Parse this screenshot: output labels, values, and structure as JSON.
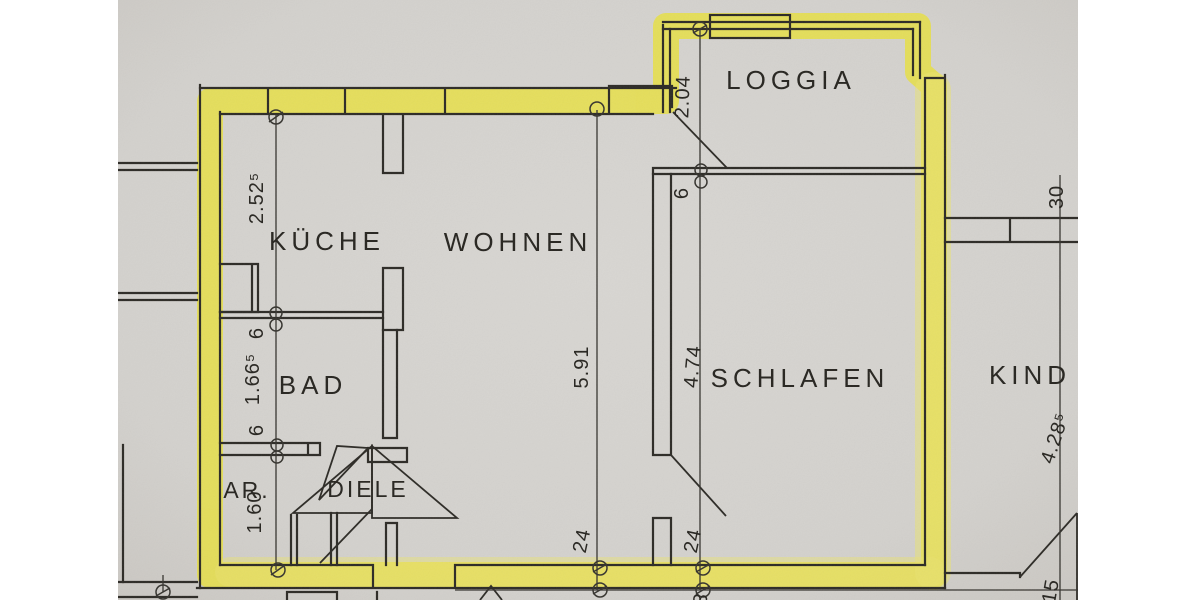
{
  "document": {
    "kind": "scanned apartment floor plan, apartment outlined with yellow highlighter",
    "language": "German"
  },
  "colors": {
    "highlight": "#e9e13e",
    "highlight_soft": "#efe75a",
    "paper": "#d5d3cf",
    "paper_edge": "#cbc8c3",
    "ink": "#2c2a25",
    "page": "#ffffff"
  },
  "rooms": {
    "kueche": {
      "label": "KÜCHE"
    },
    "wohnen": {
      "label": "WOHNEN"
    },
    "loggia": {
      "label": "LOGGIA"
    },
    "bad": {
      "label": "BAD"
    },
    "abstellraum": {
      "label": "AR."
    },
    "diele": {
      "label": "DIELE"
    },
    "schlafen": {
      "label": "SCHLAFEN"
    },
    "kind": {
      "label": "KIND"
    }
  },
  "dimensions": {
    "kueche_side": "2.52⁵",
    "kueche_bad_wall": "6",
    "bad_side": "1.66⁵",
    "bad_ar_wall": "6",
    "ar_side": "1.60",
    "wohnen_depth": "5.91",
    "wohnen_wall_bottom": "24",
    "schlafen_depth": "4.74",
    "schlafen_wall_bottom": "24",
    "loggia_width": "2.04",
    "loggia_door": "6",
    "kind_wall_top": "30",
    "kind_depth": "4.28⁵",
    "kind_bottom": "15",
    "bottom_partial": "3"
  }
}
